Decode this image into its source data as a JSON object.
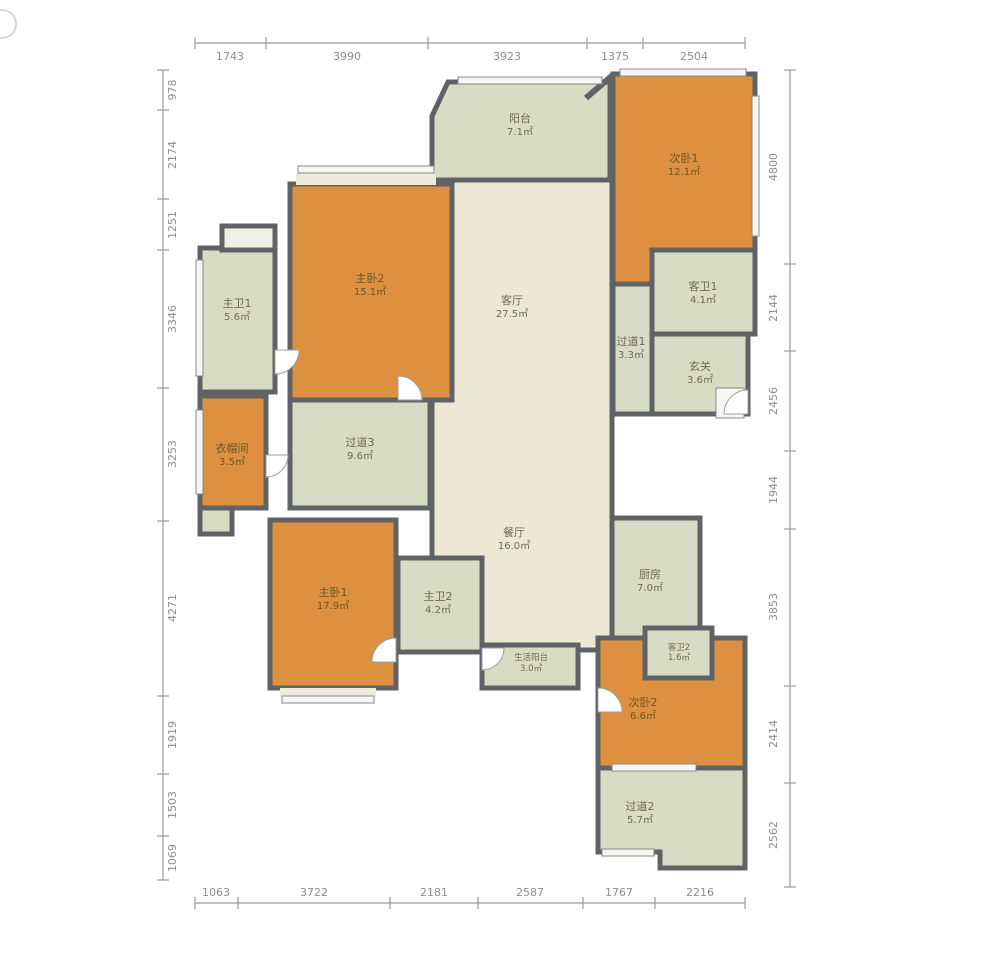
{
  "plan": {
    "title": "apartment-floor-plan",
    "unit_symbol": "㎡"
  },
  "colors": {
    "bedroom_orange": "#dd9140",
    "living_cream": "#ece8d5",
    "wet_green": "#d9dcc5",
    "sill_cream": "#eeeadb",
    "wall_dark": "#5f6365",
    "dim_gray": "#9a9a9a"
  },
  "dimensions": {
    "top": [
      "1743",
      "3990",
      "3923",
      "1375",
      "2504"
    ],
    "bottom": [
      "1063",
      "3722",
      "2181",
      "2587",
      "1767",
      "2216"
    ],
    "left": [
      "978",
      "2174",
      "1251",
      "3346",
      "3253",
      "4271",
      "1919",
      "1503",
      "1069"
    ],
    "right": [
      "4800",
      "2144",
      "2456",
      "1944",
      "3853",
      "2414",
      "2562"
    ]
  },
  "rooms": [
    {
      "name": "阳台",
      "area": "7.1㎡"
    },
    {
      "name": "次卧1",
      "area": "12.1㎡"
    },
    {
      "name": "客卫1",
      "area": "4.1㎡"
    },
    {
      "name": "过道1",
      "area": "3.3㎡"
    },
    {
      "name": "玄关",
      "area": "3.6㎡"
    },
    {
      "name": "主卧2",
      "area": "15.1㎡"
    },
    {
      "name": "主卫1",
      "area": "5.6㎡"
    },
    {
      "name": "衣帽间",
      "area": "3.5㎡"
    },
    {
      "name": "过道3",
      "area": "9.6㎡"
    },
    {
      "name": "客厅",
      "area": "27.5㎡"
    },
    {
      "name": "餐厅",
      "area": "16.0㎡"
    },
    {
      "name": "厨房",
      "area": "7.0㎡"
    },
    {
      "name": "生活阳台",
      "area": "3.0㎡"
    },
    {
      "name": "主卧1",
      "area": "17.9㎡"
    },
    {
      "name": "主卫2",
      "area": "4.2㎡"
    },
    {
      "name": "客卫2",
      "area": "1.6㎡"
    },
    {
      "name": "次卧2",
      "area": "6.6㎡"
    },
    {
      "name": "过道2",
      "area": "5.7㎡"
    }
  ]
}
